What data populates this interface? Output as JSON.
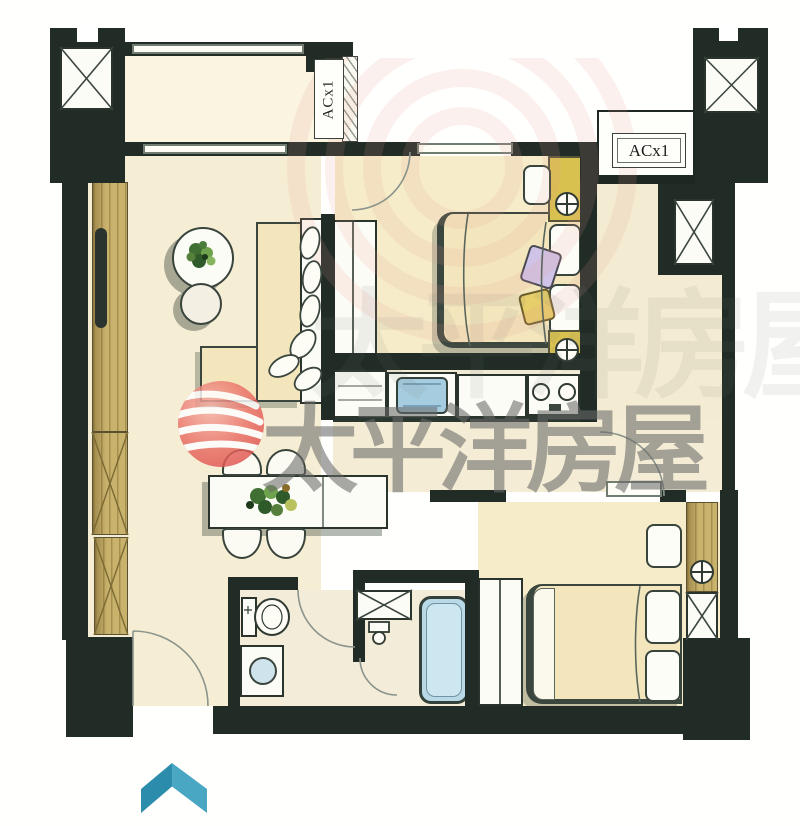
{
  "title": "apartment-floor-plan-scan",
  "labels": {
    "ac_top": "ACx1",
    "ac_right": "ACx1"
  },
  "watermark": {
    "brand_text": "太平洋房屋",
    "text_color": "#696969",
    "logo_color": "#e25550"
  },
  "compass": {
    "shape": "chevron-up",
    "color_left": "#2c8cab",
    "color_right": "#4aa7c4"
  },
  "palette": {
    "wall": "#212c26",
    "floor_living": "#f6eed4",
    "floor_bedroom": "#f6ecc9",
    "floor_balcony": "#faf4e0",
    "wood": "#c9b26c",
    "water_blue": "#a5cddf",
    "tub_blue": "#b9d9e6",
    "lamp_yellow": "#d9c14f",
    "bed_beige": "#f3e6bd"
  },
  "icons": {
    "shaft": "crossed-box-icon",
    "wall_lamp": "circle-plus-icon",
    "door": "quarter-arc-icon",
    "window": "double-line-icon",
    "wardrobe": "diagonal-hatch-icon",
    "stove": "two-burner-icon",
    "north_arrow": "chevron-up-icon"
  }
}
